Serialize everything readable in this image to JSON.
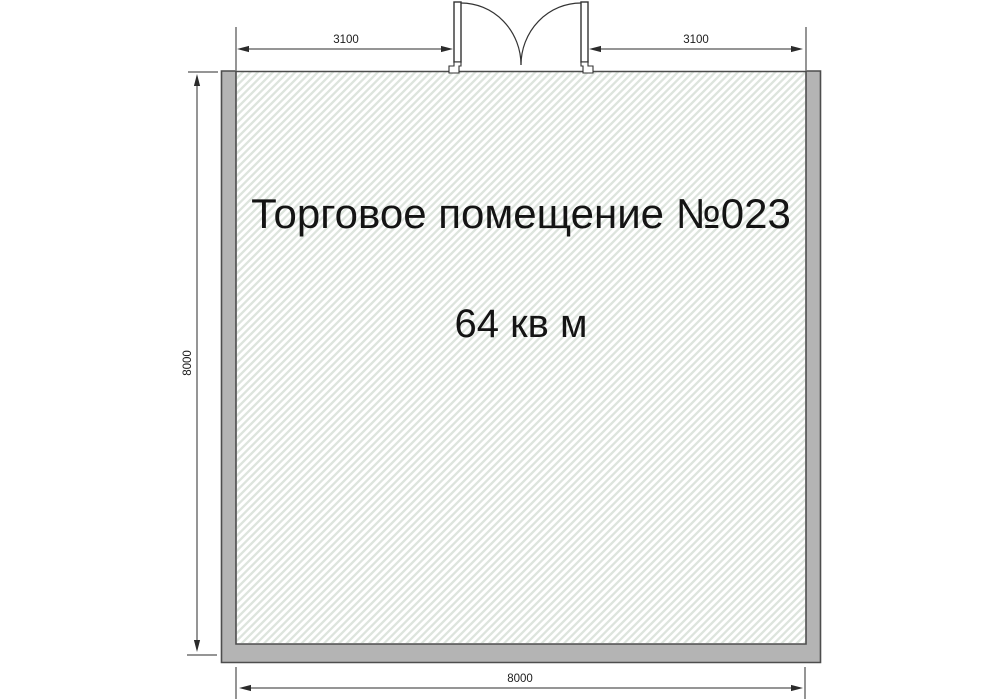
{
  "page": {
    "type": "floor-plan",
    "background": "#ffffff"
  },
  "room": {
    "title": "Торговое помещение №023",
    "area": "64 кв м"
  },
  "dimensions": {
    "top_left_width": "3100",
    "top_right_width": "3100",
    "left_height": "8000",
    "bottom_width": "8000"
  },
  "colors": {
    "wall_fill": "#b4b4b4",
    "wall_outline": "#4d4d4d",
    "hatch_line": "#dde4dd",
    "dimension_line": "#2b2b2b",
    "text": "#141414"
  }
}
